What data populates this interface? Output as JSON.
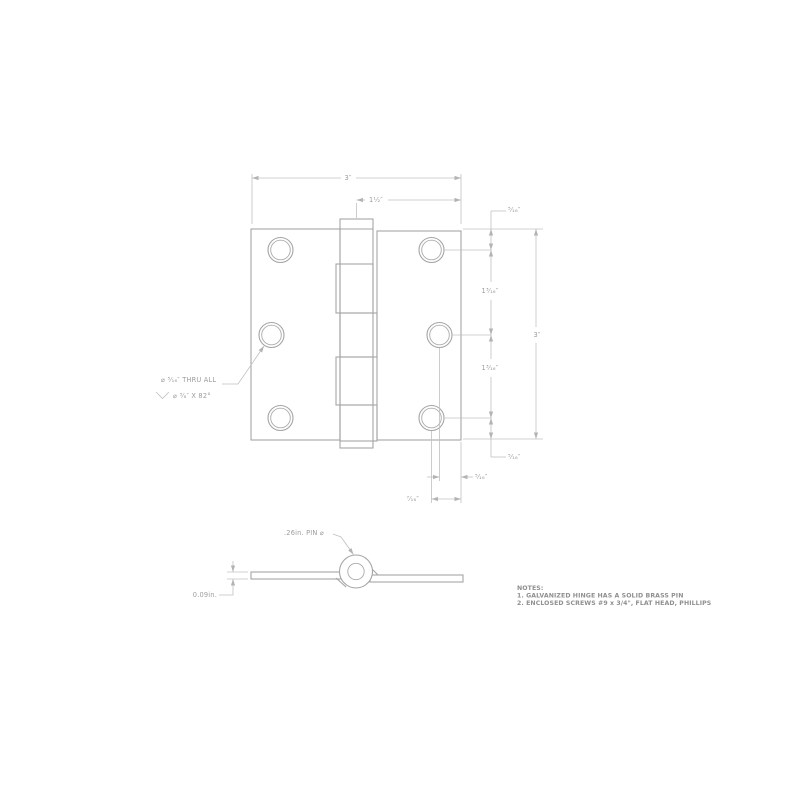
{
  "colors": {
    "background": "#ffffff",
    "object_line": "#a5a5a5",
    "dimension_line": "#c0c0c0",
    "dimension_text": "#9c9c9c",
    "notes_text": "#8f8f8f"
  },
  "top_view": {
    "dims": {
      "width": "3″",
      "pin_to_edge": "1¹⁄₂″",
      "margin_top": "⁵⁄₁₆″",
      "spacing_upper": "1³⁄₁₆″",
      "height": "3″",
      "spacing_lower": "1³⁄₁₆″",
      "margin_bottom": "⁵⁄₁₆″",
      "hole_to_side_edge": "⁵⁄₁₆″",
      "hole_to_corner_edge": "⁷⁄₁₆″"
    },
    "hole_callout": {
      "line1": "⌀ ⁵⁄₁₆″ THRU ALL",
      "line2": "⌀ ³⁄₈″ X 82°"
    }
  },
  "side_view": {
    "pin_diameter_label": ".26in. PIN ⌀",
    "leaf_thickness_label": "0.09in."
  },
  "notes": {
    "heading": "NOTES:",
    "items": [
      "1.  GALVANIZED HINGE HAS A SOLID BRASS PIN",
      "2.  ENCLOSED SCREWS #9 x 3/4\", FLAT HEAD, PHILLIPS"
    ]
  }
}
